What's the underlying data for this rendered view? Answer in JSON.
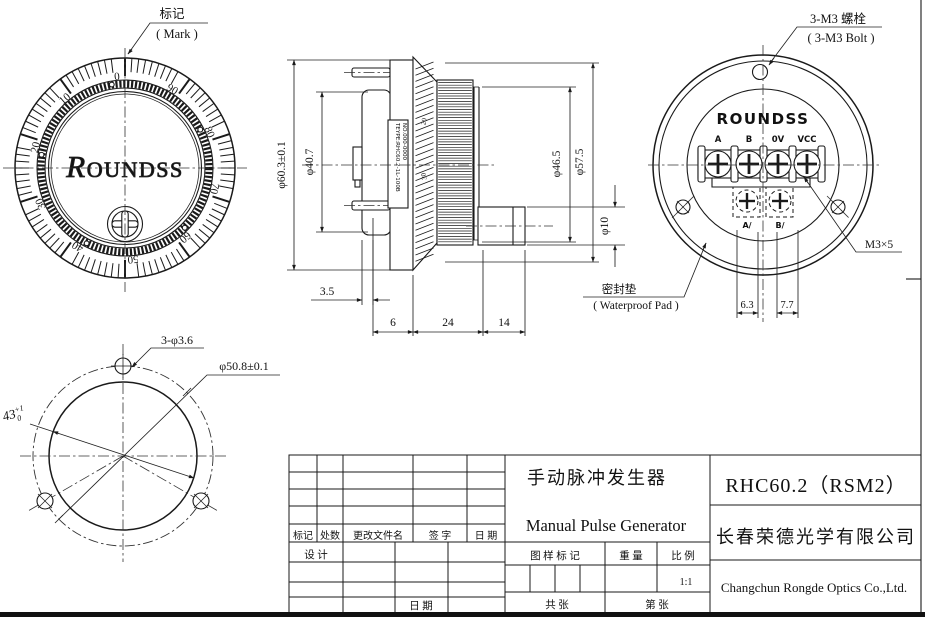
{
  "drawing": {
    "front_view": {
      "mark_label_cn": "标记",
      "mark_label_en": "( Mark )",
      "logo_r": "R",
      "logo_rest": "OUNDSS",
      "dial_numbers": [
        "0",
        "10",
        "20",
        "30",
        "40",
        "50",
        "60",
        "70",
        "80",
        "90"
      ]
    },
    "side_view": {
      "dim_outer": "φ60.3±0.1",
      "dim_flange": "φ40.7",
      "dim_rim": "φ46.5",
      "dim_wheel": "φ57.5",
      "dim_shaft": "φ10",
      "dim_pad": "3.5",
      "dim_a": "6",
      "dim_b": "24",
      "dim_c": "14",
      "label_line1": "TEYPE:RHC60.2-1L-100B",
      "label_line2": "NO.000-0000",
      "edge_numbers": [
        "20",
        "30"
      ]
    },
    "back_view": {
      "bolt_cn": "3-M3 螺栓",
      "bolt_en": "( 3-M3 Bolt )",
      "logo": "ROUNDSS",
      "terminals": [
        "A",
        "B",
        "0V",
        "VCC"
      ],
      "terminals2": [
        "A/",
        "B/"
      ],
      "screw_spec": "M3×5",
      "pad_cn": "密封垫",
      "pad_en": "( Waterproof Pad )",
      "dim_left": "6.3",
      "dim_right": "7.7"
    },
    "mount_view": {
      "dim_holes": "3-φ3.6",
      "dim_circle": "φ50.8±0.1",
      "dim_chord": "43",
      "tol_hi": "+1",
      "tol_lo": "0"
    },
    "title_block": {
      "title_cn": "手动脉冲发生器",
      "title_en": "Manual Pulse Generator",
      "model": "RHC60.2（RSM2）",
      "company_cn": "长春荣德光学有限公司",
      "company_en": "Changchun Rongde Optics Co.,Ltd.",
      "rev_headers": [
        "标记",
        "处数",
        "更改文件名",
        "签  字",
        "日  期"
      ],
      "design": "设  计",
      "date": "日  期",
      "mark": "图 样 标 记",
      "weight": "重  量",
      "scale": "比  例",
      "scale_val": "1:1",
      "total": "共      张",
      "number": "第      张"
    }
  }
}
